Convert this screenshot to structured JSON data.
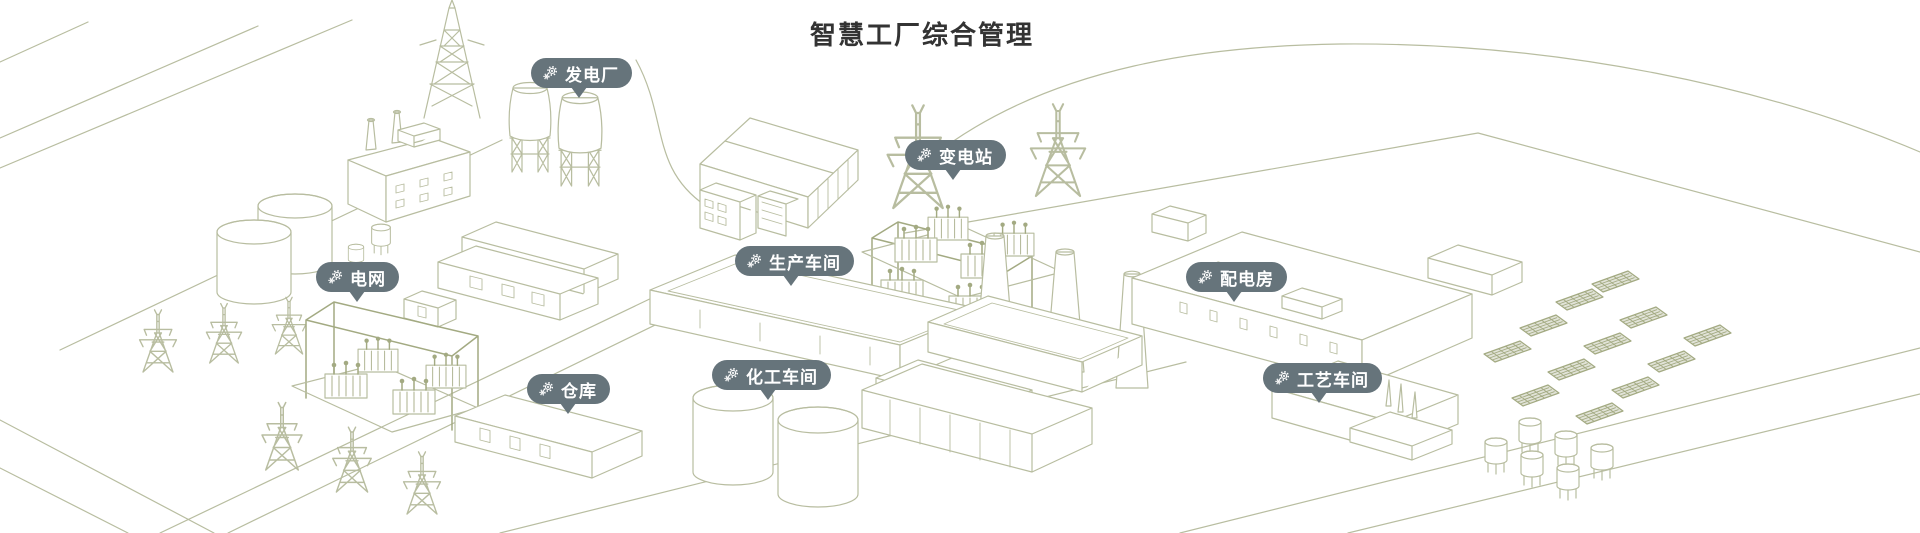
{
  "title": "智慧工厂综合管理",
  "colors": {
    "background": "#FFFFFF",
    "line_art": "#B8BDA0",
    "line_art_dense": "#A3AA82",
    "badge_background": "#66747B",
    "badge_text": "#FFFFFF",
    "title_text": "#333333"
  },
  "pins": [
    {
      "id": "power-plant",
      "label": "发电厂",
      "icon": "gears-icon"
    },
    {
      "id": "substation",
      "label": "变电站",
      "icon": "gears-icon"
    },
    {
      "id": "power-grid",
      "label": "电网",
      "icon": "gears-icon"
    },
    {
      "id": "production-workshop",
      "label": "生产车间",
      "icon": "gears-icon"
    },
    {
      "id": "distribution-room",
      "label": "配电房",
      "icon": "gears-icon"
    },
    {
      "id": "warehouse",
      "label": "仓库",
      "icon": "gears-icon"
    },
    {
      "id": "chemical-workshop",
      "label": "化工车间",
      "icon": "gears-icon"
    },
    {
      "id": "process-workshop",
      "label": "工艺车间",
      "icon": "gears-icon"
    }
  ]
}
